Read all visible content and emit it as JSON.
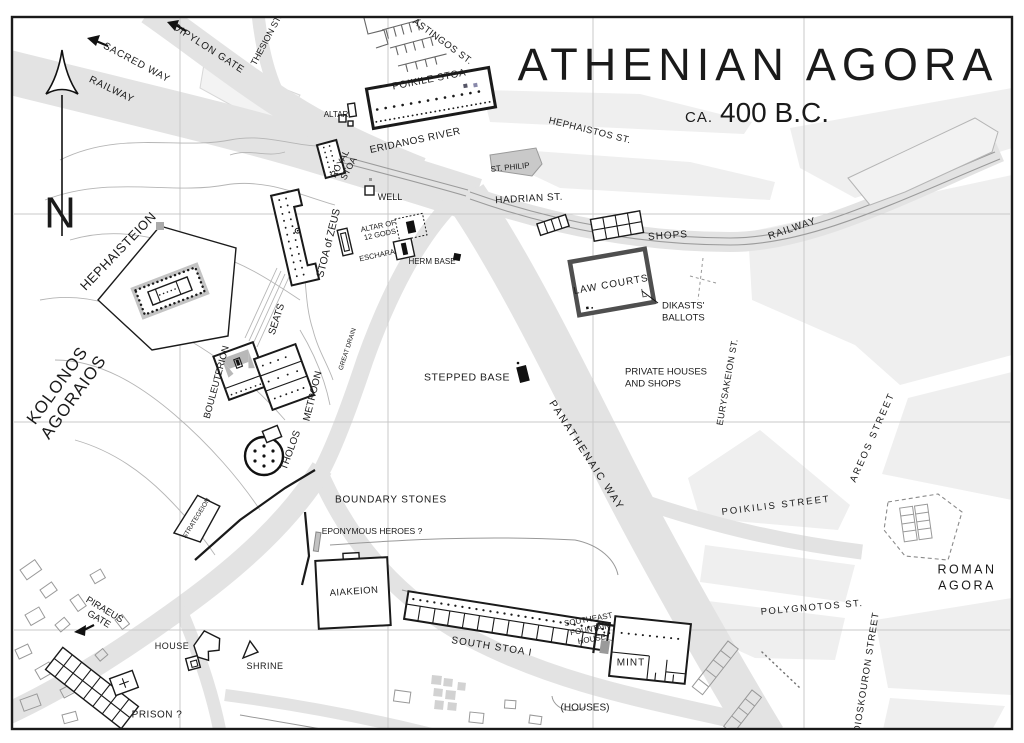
{
  "title": {
    "main": "ATHENIAN AGORA",
    "sub_small": "CA.",
    "sub_large": "400 B.C."
  },
  "colors": {
    "ink": "#1a1a1a",
    "road": "#e3e3e3",
    "block": "#efefef",
    "grid": "#c9c9c9",
    "contour": "#b5b5b5",
    "lawcourt_border": "#4f4f4f"
  },
  "compass": {
    "letter": "N"
  },
  "labels": [
    {
      "id": "sacred-way",
      "text": "SACRED WAY",
      "x": 137,
      "y": 62,
      "rot": 28,
      "size": 10,
      "sp": 0.8
    },
    {
      "id": "railway-nw",
      "text": "RAILWAY",
      "x": 112,
      "y": 89,
      "rot": 26,
      "size": 10,
      "sp": 0.8
    },
    {
      "id": "dipylon-gate",
      "text": "DIPYLON GATE",
      "x": 209,
      "y": 48,
      "rot": 33,
      "size": 10,
      "sp": 0.8
    },
    {
      "id": "thesion-st",
      "text": "THESION ST.",
      "x": 266,
      "y": 40,
      "rot": -62,
      "size": 9
    },
    {
      "id": "astingos-st",
      "text": "ASTINGOS ST.",
      "x": 443,
      "y": 41,
      "rot": 36,
      "size": 9.5,
      "sp": 0.5
    },
    {
      "id": "poikile-stoa",
      "text": "POIKILE STOA",
      "x": 429,
      "y": 79,
      "rot": -11,
      "size": 10,
      "sp": 0.5
    },
    {
      "id": "altar-north",
      "text": "ALTAR",
      "x": 336,
      "y": 114,
      "rot": 0,
      "size": 8
    },
    {
      "id": "eridanos-river",
      "text": "ERIDANOS RIVER",
      "x": 415,
      "y": 140,
      "rot": -12,
      "size": 10,
      "sp": 0.5
    },
    {
      "id": "royal-stoa",
      "lines": [
        "ROYAL",
        "STOA"
      ],
      "x": 344,
      "y": 166,
      "rot": -62,
      "size": 9,
      "lh": 10
    },
    {
      "id": "stoa-of-zeus",
      "text": "STOA of ZEUS",
      "x": 328,
      "y": 243,
      "rot": -76,
      "size": 10.5
    },
    {
      "id": "well",
      "text": "WELL",
      "x": 390,
      "y": 197,
      "rot": 0,
      "size": 9
    },
    {
      "id": "altar-of-12-gods",
      "lines": [
        "ALTAR OF",
        "12 GODS"
      ],
      "x": 379,
      "y": 230,
      "rot": -12,
      "size": 7.5,
      "lh": 8.5
    },
    {
      "id": "eschara",
      "text": "ESCHARA",
      "x": 377,
      "y": 255,
      "rot": -12,
      "size": 7.5
    },
    {
      "id": "herm-base",
      "text": "HERM BASE",
      "x": 432,
      "y": 261,
      "rot": 0,
      "size": 8
    },
    {
      "id": "st-philip",
      "text": "ST. PHILIP",
      "x": 510,
      "y": 167,
      "rot": -6,
      "size": 8
    },
    {
      "id": "hephaistos-st",
      "text": "HEPHAISTOS ST.",
      "x": 590,
      "y": 130,
      "rot": 14,
      "size": 9.5,
      "sp": 0.5
    },
    {
      "id": "hadrian-st",
      "text": "HADRIAN ST.",
      "x": 529,
      "y": 198,
      "rot": -3,
      "size": 10,
      "sp": 0.5
    },
    {
      "id": "shops",
      "text": "SHOPS",
      "x": 668,
      "y": 235,
      "rot": -4,
      "size": 10,
      "sp": 1
    },
    {
      "id": "railway-ne",
      "text": "RAILWAY",
      "x": 792,
      "y": 228,
      "rot": -19,
      "size": 10,
      "sp": 1
    },
    {
      "id": "law-courts",
      "text": "LAW COURTS",
      "x": 611,
      "y": 284,
      "rot": -10,
      "size": 10,
      "sp": 1
    },
    {
      "id": "dikasts-ballots",
      "lines": [
        "DIKASTS'",
        "BALLOTS"
      ],
      "x": 662,
      "y": 311,
      "rot": 0,
      "size": 9.5,
      "lh": 12,
      "anchor": "start"
    },
    {
      "id": "private-houses-and-shops",
      "lines": [
        "PRIVATE HOUSES",
        "AND SHOPS"
      ],
      "x": 625,
      "y": 377,
      "rot": 0,
      "size": 9.5,
      "lh": 12,
      "anchor": "start"
    },
    {
      "id": "eurysakeion-st",
      "text": "EURYSAKEION ST.",
      "x": 727,
      "y": 382,
      "rot": -80,
      "size": 9,
      "sp": 0.5
    },
    {
      "id": "stepped-base",
      "text": "STEPPED BASE",
      "x": 467,
      "y": 377,
      "rot": 0,
      "size": 10.5,
      "sp": 0.5
    },
    {
      "id": "panathenaic-way",
      "text": "PANATHENAIC WAY",
      "x": 587,
      "y": 455,
      "rot": 57,
      "size": 10.5,
      "sp": 2
    },
    {
      "id": "areos-street",
      "text": "AREOS STREET",
      "x": 872,
      "y": 437,
      "rot": -66,
      "size": 9.5,
      "sp": 2
    },
    {
      "id": "poikilis-street",
      "text": "POIKILIS STREET",
      "x": 776,
      "y": 505,
      "rot": -7,
      "size": 9.5,
      "sp": 2
    },
    {
      "id": "roman-agora",
      "lines": [
        "ROMAN",
        "AGORA"
      ],
      "x": 967,
      "y": 577,
      "rot": 0,
      "size": 12.5,
      "sp": 2.5,
      "lh": 16
    },
    {
      "id": "polygnotos-st",
      "text": "POLYGNOTOS ST.",
      "x": 812,
      "y": 607,
      "rot": -5,
      "size": 9.5,
      "sp": 1.5
    },
    {
      "id": "dioskouron-street",
      "text": "DIOSKOURON STREET",
      "x": 866,
      "y": 672,
      "rot": -81,
      "size": 9.5,
      "sp": 1
    },
    {
      "id": "kolonos-agoraios",
      "lines": [
        "KOLONOS",
        "AGORAIOS"
      ],
      "x": 65,
      "y": 391,
      "rot": -54,
      "size": 17,
      "sp": 1,
      "lh": 20
    },
    {
      "id": "hephaisteion",
      "text": "HEPHAISTEION",
      "x": 118,
      "y": 251,
      "rot": -46,
      "size": 13,
      "sp": 0.5
    },
    {
      "id": "seats",
      "text": "SEATS",
      "x": 276,
      "y": 319,
      "rot": -72,
      "size": 10
    },
    {
      "id": "bouleuterion",
      "text": "BOULEUTERION",
      "x": 216,
      "y": 382,
      "rot": -75,
      "size": 9.5
    },
    {
      "id": "metroon",
      "text": "METROON",
      "x": 312,
      "y": 396,
      "rot": -76,
      "size": 10
    },
    {
      "id": "great-drain",
      "text": "GREAT DRAIN",
      "x": 347,
      "y": 349,
      "rot": -72,
      "size": 6.5
    },
    {
      "id": "tholos",
      "text": "THOLOS",
      "x": 290,
      "y": 450,
      "rot": -70,
      "size": 10
    },
    {
      "id": "strategeion",
      "text": "STRATEGEION",
      "x": 196,
      "y": 518,
      "rot": -58,
      "size": 6.5
    },
    {
      "id": "boundary-stones",
      "text": "BOUNDARY STONES",
      "x": 391,
      "y": 499,
      "rot": 0,
      "size": 10,
      "sp": 0.8
    },
    {
      "id": "eponymous-heroes",
      "text": "EPONYMOUS HEROES ?",
      "x": 372,
      "y": 531,
      "rot": 0,
      "size": 8.5
    },
    {
      "id": "aiakeion",
      "text": "AIAKEION",
      "x": 354,
      "y": 591,
      "rot": -4,
      "size": 9.5,
      "sp": 0.5
    },
    {
      "id": "south-stoa-i",
      "text": "SOUTH STOA I",
      "x": 492,
      "y": 646,
      "rot": 9,
      "size": 10,
      "sp": 1
    },
    {
      "id": "southeast-fountain-house",
      "lines": [
        "SOUTHEAST",
        "FOUNTAIN",
        "HOUSE"
      ],
      "x": 590,
      "y": 629,
      "rot": -10,
      "size": 8,
      "lh": 10
    },
    {
      "id": "mint",
      "text": "MINT",
      "x": 631,
      "y": 662,
      "rot": 0,
      "size": 10,
      "sp": 1
    },
    {
      "id": "houses",
      "text": "(HOUSES)",
      "x": 585,
      "y": 707,
      "rot": 0,
      "size": 10
    },
    {
      "id": "house",
      "text": "HOUSE",
      "x": 172,
      "y": 646,
      "rot": 0,
      "size": 9,
      "sp": 0.5
    },
    {
      "id": "shrine",
      "text": "SHRINE",
      "x": 265,
      "y": 666,
      "rot": 0,
      "size": 9,
      "sp": 0.5
    },
    {
      "id": "prison",
      "text": "PRISON ?",
      "x": 157,
      "y": 714,
      "rot": 0,
      "size": 10,
      "sp": 0.5
    },
    {
      "id": "piraeus-gate",
      "lines": [
        "PIRAEUS",
        "GATE"
      ],
      "x": 102,
      "y": 614,
      "rot": 31,
      "size": 9.5,
      "lh": 11
    },
    {
      "id": "north-indicator",
      "text": "N",
      "x": 60,
      "y": 212,
      "rot": 0,
      "size": 44
    }
  ]
}
